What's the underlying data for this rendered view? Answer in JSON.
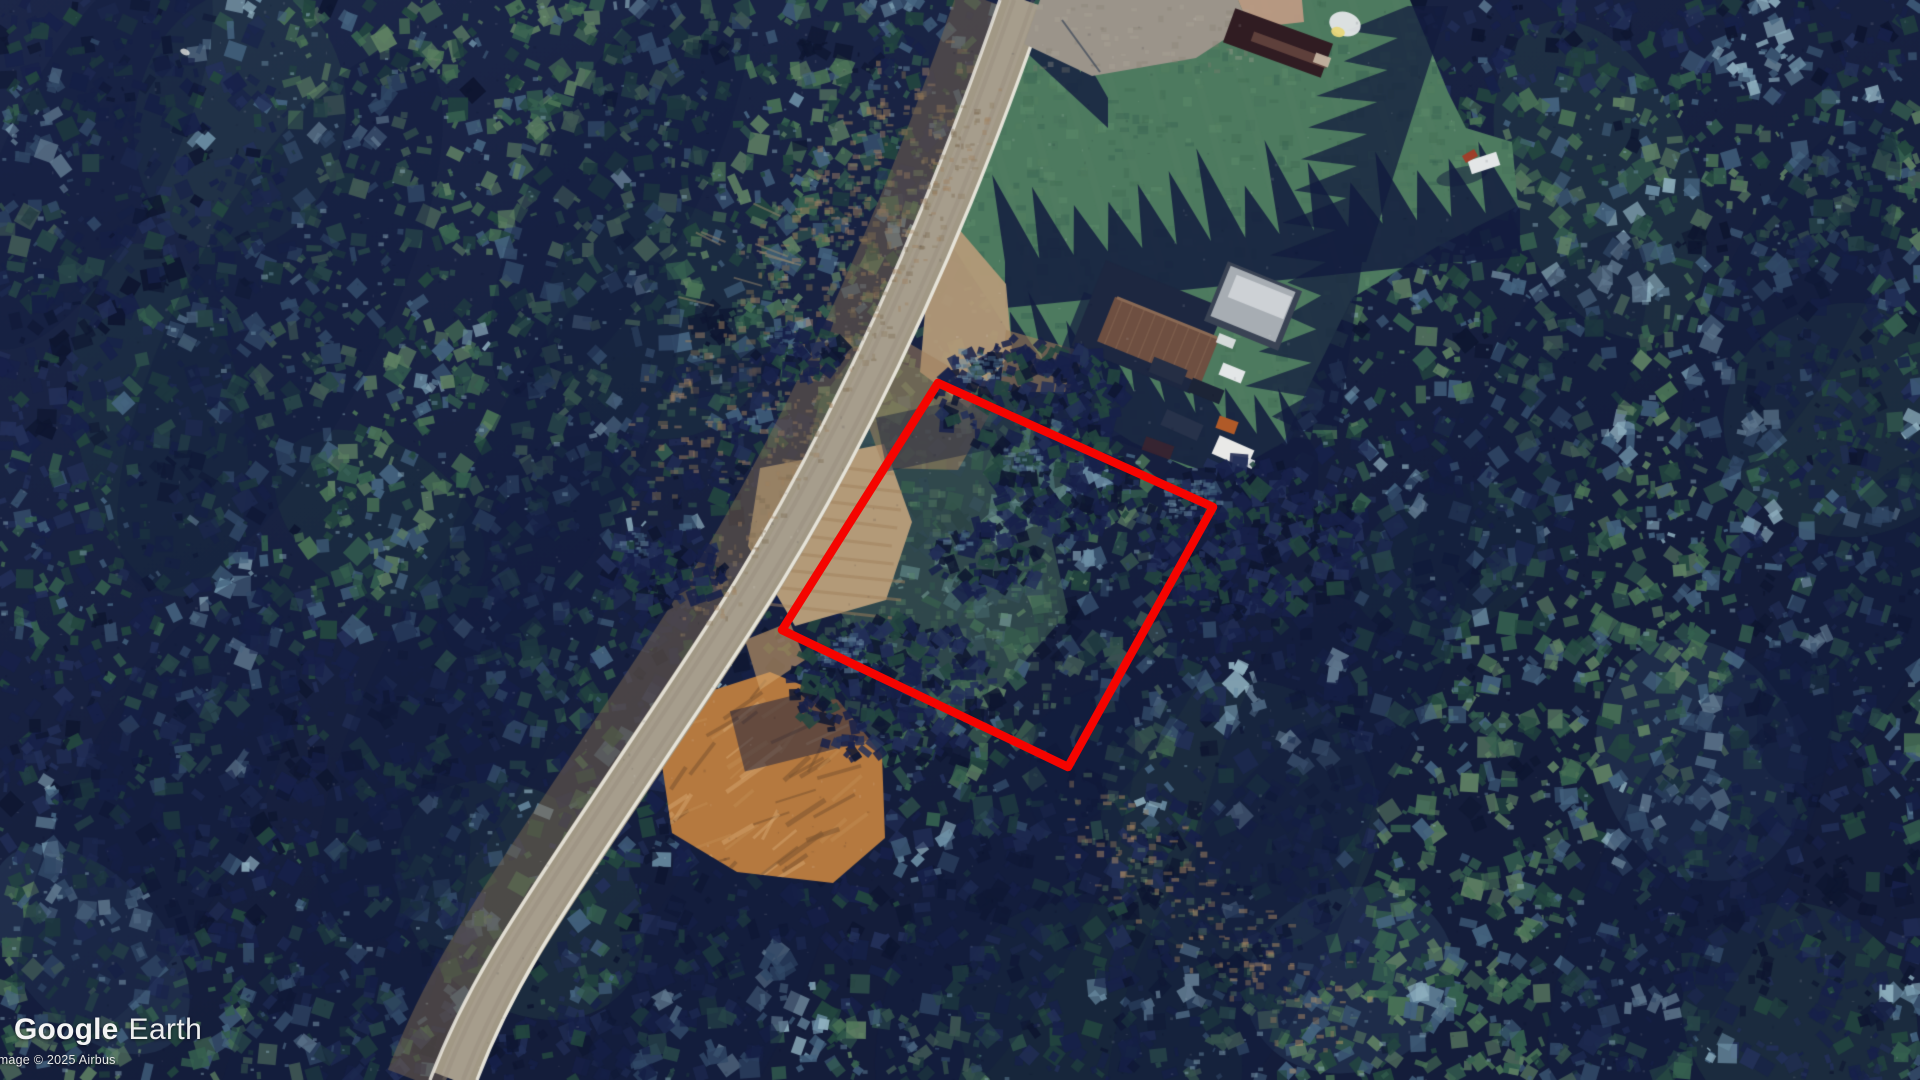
{
  "app": {
    "name": "Google Earth",
    "view_mode": "satellite-imagery"
  },
  "watermark": {
    "google": "Google",
    "earth": "Earth",
    "attribution": "Image © 2025 Airbus"
  },
  "map": {
    "description": "Aerial view of forested rural parcel: diagonal two-lane road, homestead with buildings and vehicles, lawn, dirt clearings, eroded soil patch, conifer forest",
    "property_boundary": {
      "color": "#f50400",
      "stroke_width": 8.5,
      "points": [
        [
          938,
          383
        ],
        [
          1213,
          507
        ],
        [
          1068,
          767
        ],
        [
          782,
          630
        ]
      ]
    }
  },
  "palette": {
    "base_top": "#1c2749",
    "base_bottom": "#141d3a",
    "forest_navy_deep": "#0e1630",
    "forest_navy": "#17214a",
    "forest_navy_mid": "#233059",
    "forest_slate": "#44637f",
    "forest_slate_light": "#6d90a6",
    "forest_steel": "#8fb0bf",
    "forest_teal_dark": "#23473f",
    "forest_teal": "#35604f",
    "forest_green": "#4a7356",
    "forest_moss": "#5e8063",
    "shadow_navy": "#131c3e",
    "lawn_green": "#4d7a5f",
    "lawn_light": "#5f8e6b",
    "lawn_dark": "#3e6850",
    "road_surface": "#a19885",
    "road_wear": "#aba294",
    "road_edge_white": "#ece9df",
    "road_shoulder": "#7b6850",
    "dirt_tan": "#b39a78",
    "dirt_brown": "#a0805c",
    "erosion_orange": "#b5793f",
    "erosion_light": "#d2a36b",
    "erosion_dark": "#7c5430",
    "roof_brown": "#6e4f41",
    "roof_ridge": "#8a6a55",
    "roof_dark": "#1d2740",
    "roof_gray": "#a7adb3",
    "roof_gray_light": "#cdd1d5",
    "roof_maroon": "#301c22",
    "vehicle_white": "#e3e6e7",
    "vehicle_dark": "#252e44",
    "vehicle_orange": "#b05a28",
    "parking_gray": "#9b948a",
    "parking_tan": "#c29b85"
  }
}
